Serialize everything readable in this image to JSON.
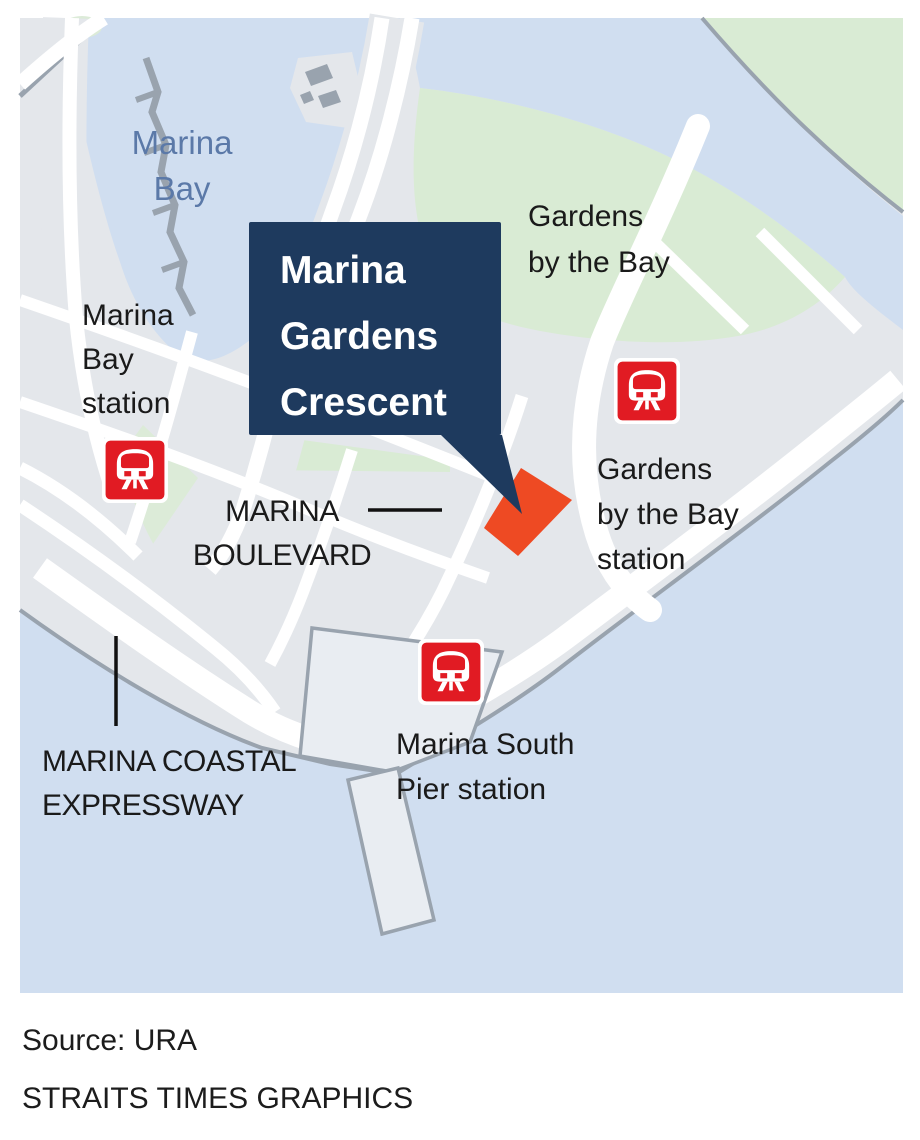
{
  "theme": {
    "page_bg": "#ffffff",
    "water": "#d0def0",
    "land": "#e4e7eb",
    "green": "#d9ebd4",
    "green_light": "#dcebd8",
    "road": "#ffffff",
    "shore": "#99a3ae",
    "platform": "#e9edf2",
    "navy": "#1e3a5e",
    "orange": "#ee4a23",
    "mrt_red": "#e11b23",
    "label": "#1a1a1a",
    "bay_label": "#5b79a8",
    "pointer": "#111111"
  },
  "callout": {
    "lines": [
      "Marina",
      "Gardens",
      "Crescent"
    ]
  },
  "labels": {
    "marina_bay": {
      "lines": [
        "Marina",
        "Bay"
      ]
    },
    "marina_bay_station": {
      "lines": [
        "Marina",
        "Bay",
        "station"
      ]
    },
    "gardens_by_the_bay": {
      "lines": [
        "Gardens",
        "by the Bay"
      ]
    },
    "gardens_by_the_bay_station": {
      "lines": [
        "Gardens",
        "by the Bay",
        "station"
      ]
    },
    "marina_boulevard": {
      "lines": [
        "MARINA",
        "BOULEVARD"
      ]
    },
    "marina_south_pier_station": {
      "lines": [
        "Marina South",
        "Pier station"
      ]
    },
    "marina_coastal_expressway": {
      "lines": [
        "MARINA COASTAL",
        "EXPRESSWAY"
      ]
    }
  },
  "footer": {
    "source": "Source: URA",
    "credit": "STRAITS TIMES GRAPHICS"
  }
}
